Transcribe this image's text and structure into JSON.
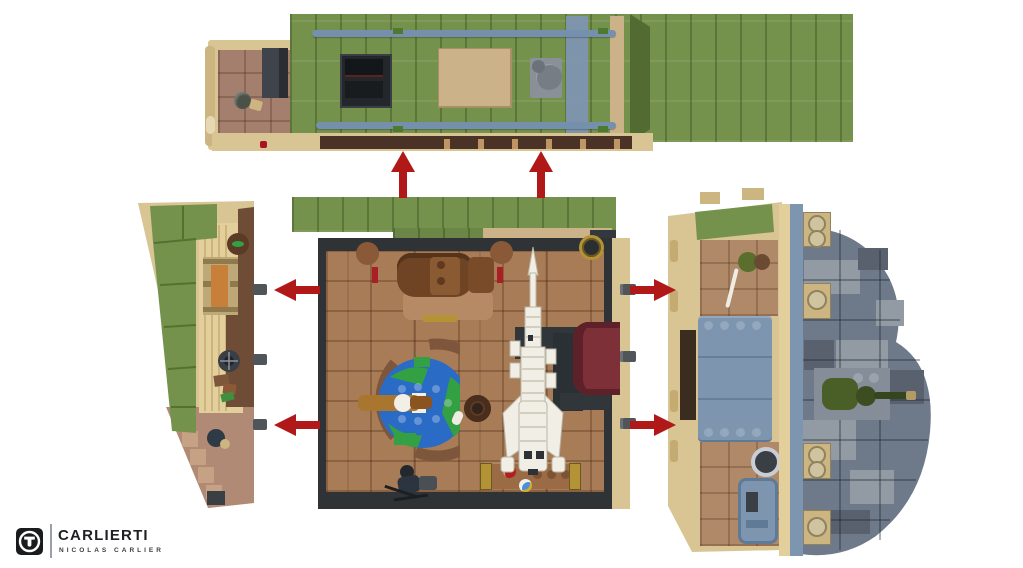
{
  "page": {
    "background": "#ffffff"
  },
  "logo": {
    "monogram": "T",
    "brand": "CARLIERTI",
    "subtitle": "NICOLAS CARLIER"
  },
  "scene": {
    "type": "lego-exploded-top-view",
    "sections": [
      {
        "id": "roof-section",
        "label": "detached green roof with skylight, bed box, stove and tan balcony"
      },
      {
        "id": "left-wall-section",
        "label": "wedge side wall with sloped green roof, bench, porthole, books and figure"
      },
      {
        "id": "main-floor-section",
        "label": "room interior with armchair desk, globe on ring table, hat, white rocket model, maroon sofa, bench and figure"
      },
      {
        "id": "right-wall-section",
        "label": "side wall with riveted panels, machinery and grey stone outcrop with soldier minifigure"
      }
    ],
    "arrows": {
      "up": 2,
      "left": 2,
      "right": 2
    }
  },
  "colors": {
    "arrow_red": "#b11818",
    "roof_olive": "#75924d",
    "tan": "#d9c493",
    "floor_brown": "#a97c58",
    "wall_charcoal": "#2f3336",
    "beam_blue_gray": "#7590ad",
    "stone_gray": "#6e7a8a",
    "sofa_maroon": "#7e3039",
    "globe_blue": "#2a6bc6",
    "globe_green": "#33a043",
    "gold": "#b39336",
    "logo_black": "#1a1b1d"
  }
}
